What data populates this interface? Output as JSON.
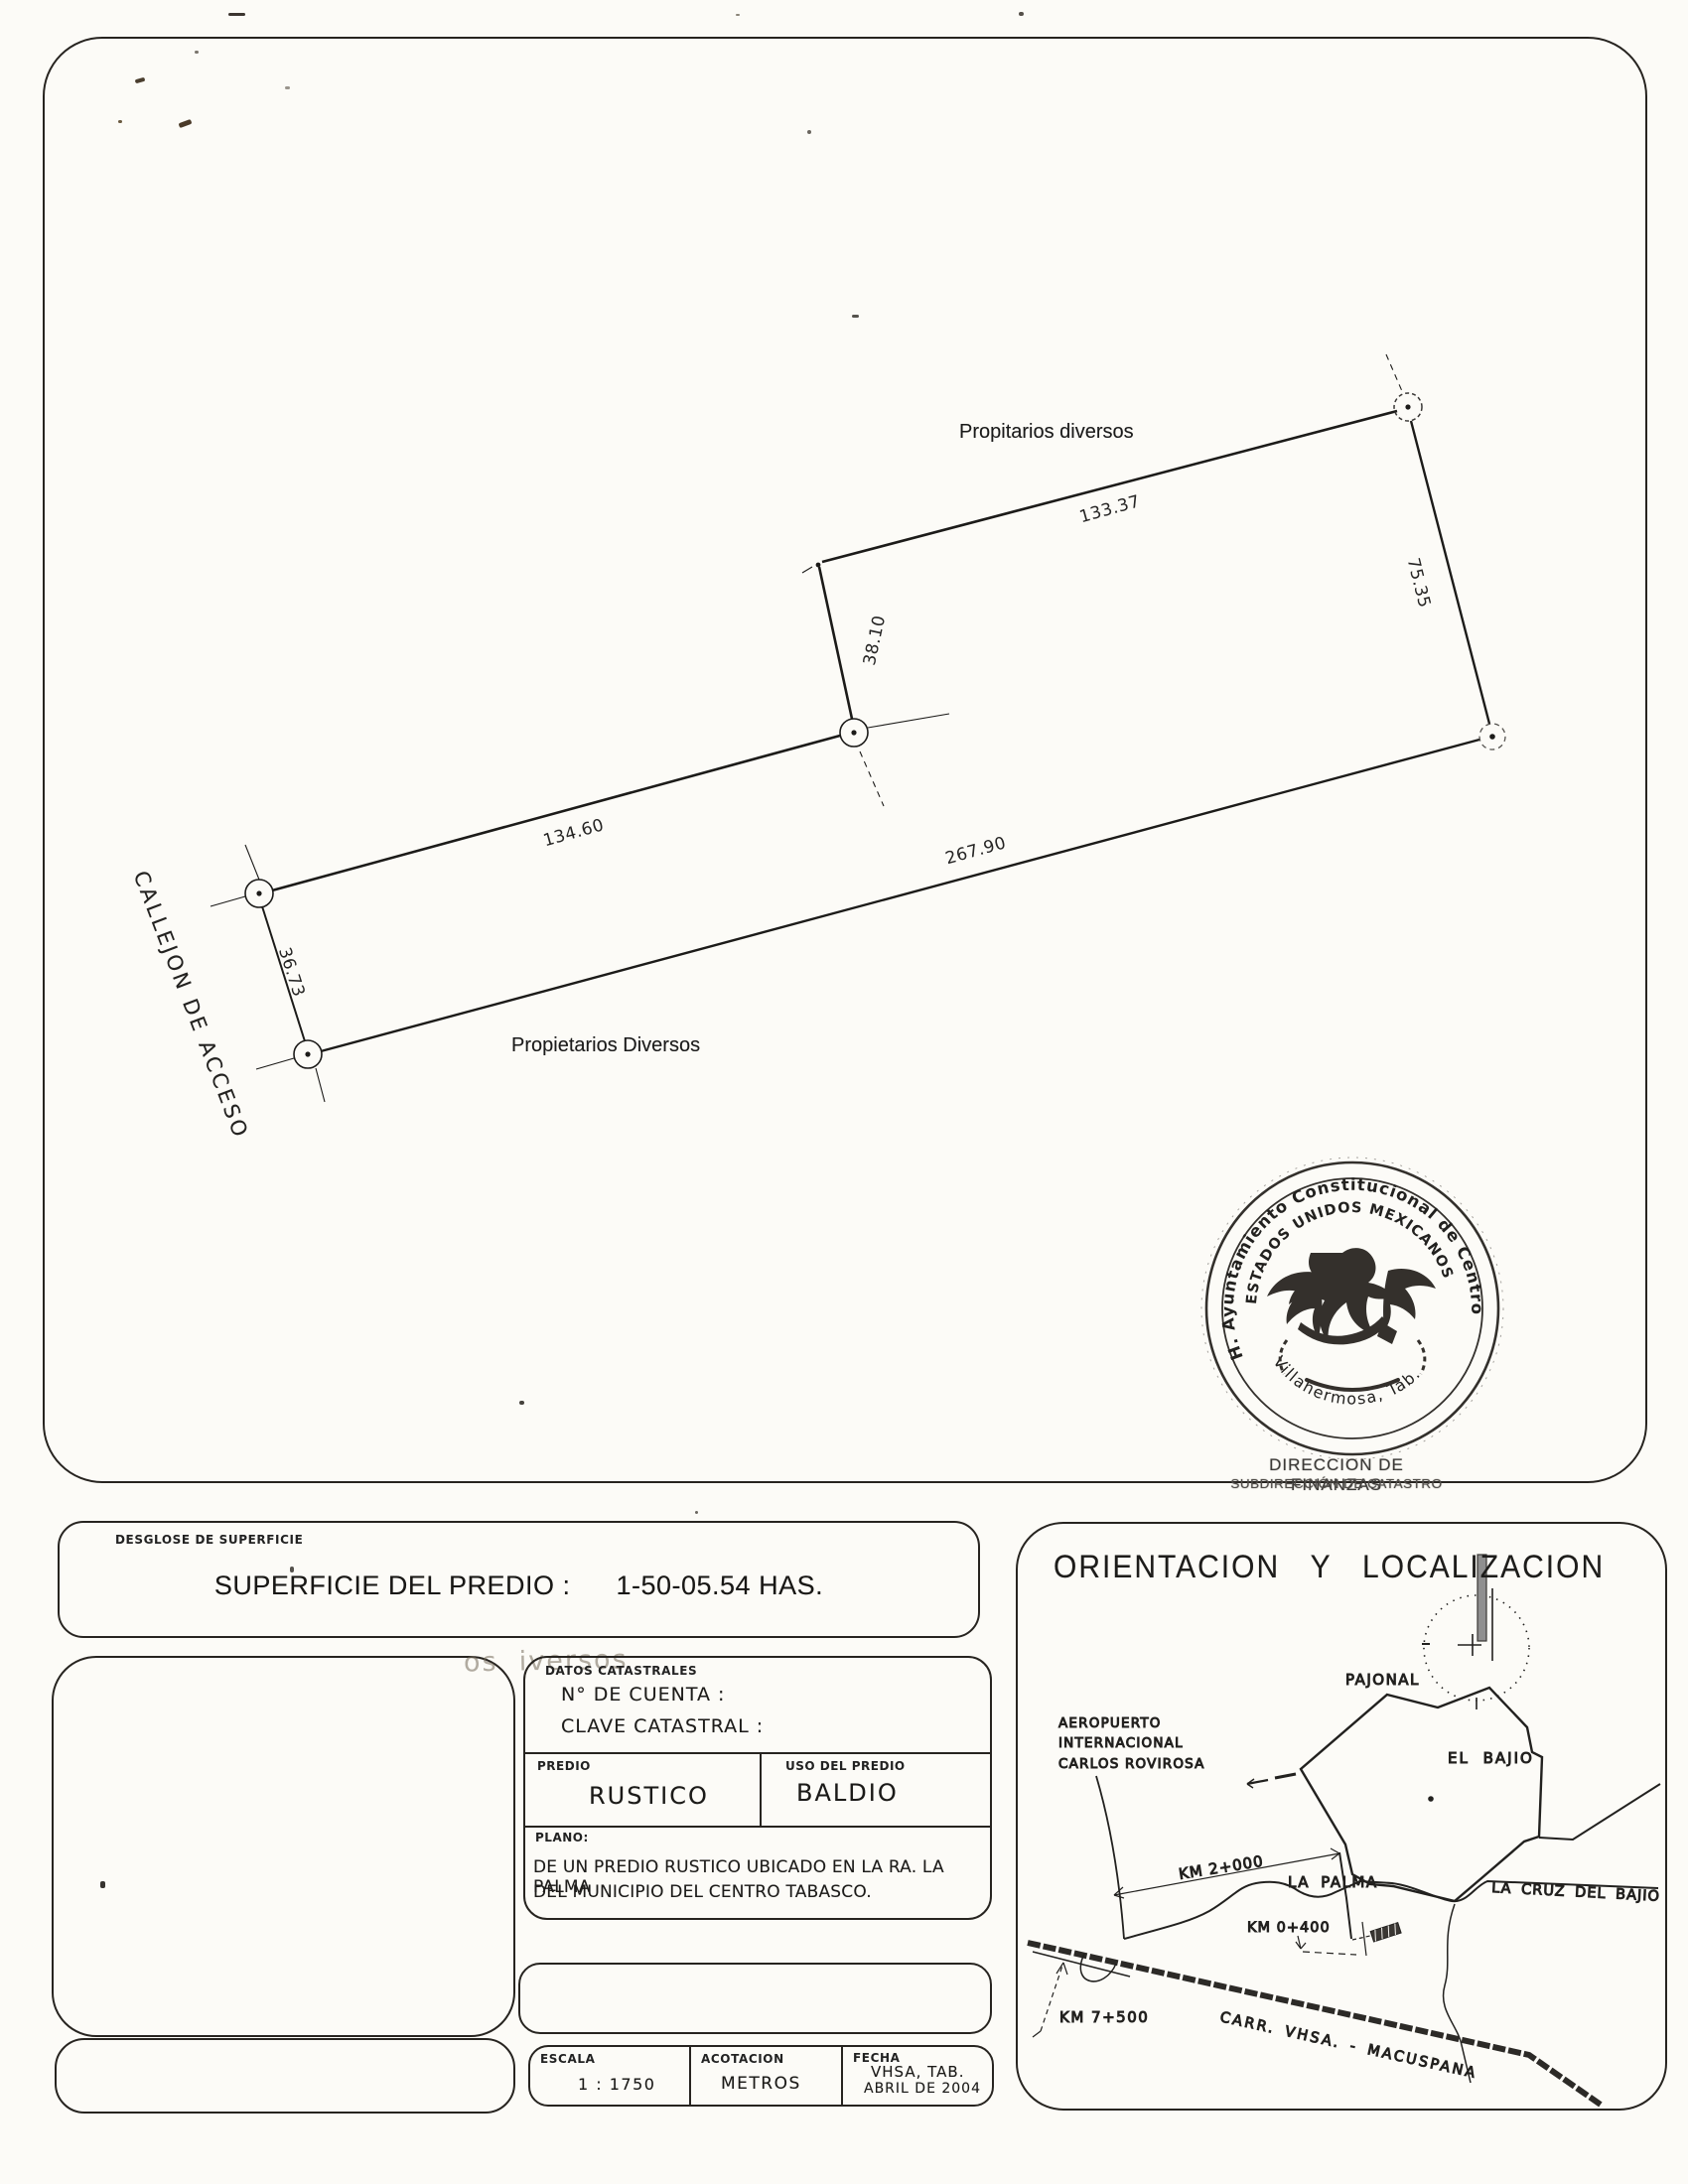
{
  "survey": {
    "neighbor_top_label": "Propitarios diversos",
    "neighbor_bottom_label": "Propietarios Diversos",
    "access_label": "CALLEJON DE ACCESO",
    "dim_top": "133.37",
    "dim_right": "75.35",
    "dim_mid": "38.10",
    "dim_upper_left": "134.60",
    "dim_bottom": "267.90",
    "dim_left": "36.73"
  },
  "seal": {
    "ring_text": "H. Ayuntamiento Constitucional de Centro",
    "arc_text": "ESTADOS UNIDOS MEXICANOS",
    "bottom_text": "Villahermosa, Tab.",
    "dept_line1": "DIRECCION DE FINANZAS",
    "dept_line2": "SUBDIRECCIÓN DE CATASTRO"
  },
  "surface_box": {
    "tab_label": "DESGLOSE DE SUPERFICIE",
    "label": "SUPERFICIE DEL PREDIO :",
    "value": "1-50-05.54 HAS."
  },
  "cadastral_box": {
    "ghost_text": "os  iversos",
    "tab_label": "DATOS CATASTRALES",
    "account_label": "N° DE CUENTA :",
    "clave_label": "CLAVE CATASTRAL :",
    "predio_label": "PREDIO",
    "predio_value": "RUSTICO",
    "uso_label": "USO DEL PREDIO",
    "uso_value": "BALDIO",
    "plano_label": "PLANO:",
    "plano_line1": "DE UN PREDIO RUSTICO UBICADO EN LA RA. LA PALMA",
    "plano_line2": "DEL MUNICIPIO DEL CENTRO TABASCO."
  },
  "title_block": {
    "escala_label": "ESCALA",
    "escala_value": "1 : 1750",
    "acotacion_label": "ACOTACION",
    "acotacion_value": "METROS",
    "fecha_label": "FECHA",
    "fecha_line1": "VHSA, TAB.",
    "fecha_line2": "ABRIL DE 2004"
  },
  "location_panel": {
    "title": "ORIENTACION   Y   LOCALIZACION",
    "pajonal": "PAJONAL",
    "el_bajio": "EL BAJIO",
    "la_palma": "LA PALMA",
    "la_cruz": "LA CRUZ DEL BAJIO",
    "airport_line1": "AEROPUERTO",
    "airport_line2": "INTERNACIONAL",
    "airport_line3": "CARLOS ROVIROSA",
    "km_2000": "KM 2+000",
    "km_0400": "KM 0+400",
    "km_7500": "KM 7+500",
    "carretera": "CARR. VHSA. - MACUSPANA"
  },
  "colors": {
    "ink": "#22211f",
    "paper": "#fcfbf7",
    "needle_gray": "#8f8f8f"
  }
}
